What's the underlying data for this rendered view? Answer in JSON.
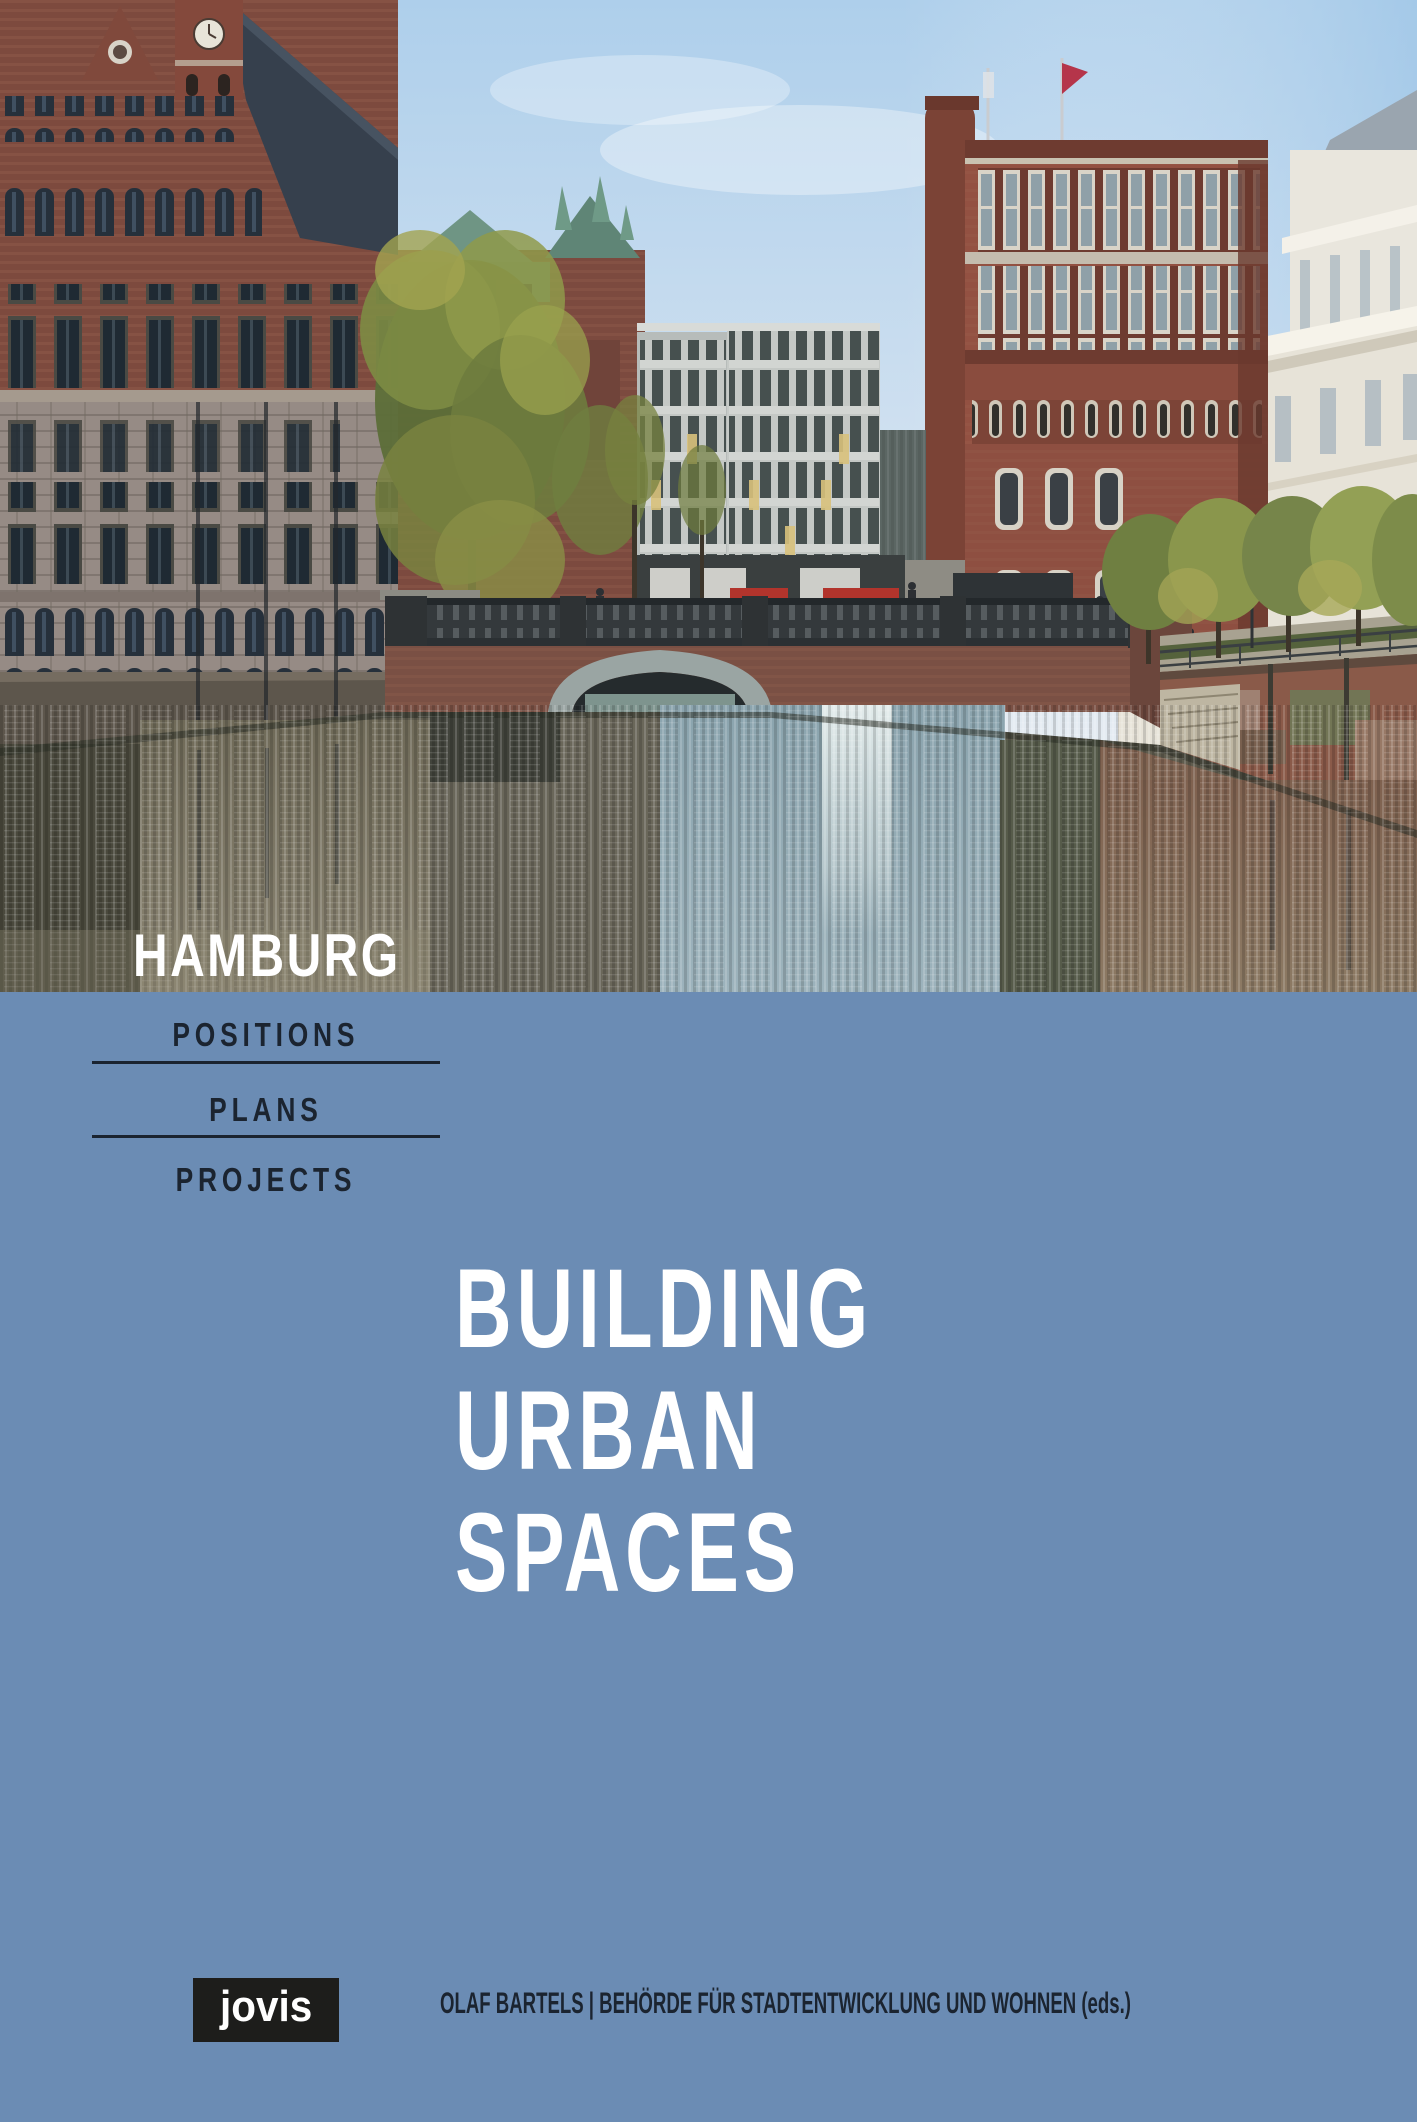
{
  "cover": {
    "location": "HAMBURG",
    "series": {
      "items": [
        {
          "label": "POSITIONS"
        },
        {
          "label": "PLANS"
        },
        {
          "label": "PROJECTS"
        }
      ]
    },
    "title": {
      "line1": "BUILDING",
      "line2": "URBAN",
      "line3": "SPACES"
    },
    "publisher_logo": "jovis",
    "editors": "OLAF BARTELS | BEHÖRDE FÜR STADTENTWICKLUNG UND WOHNEN (eds.)",
    "colors": {
      "panel": "#6b8cb4",
      "ink": "#1b2430",
      "paper": "#ffffff",
      "logo-bg": "#1d1d1b",
      "sky-top": "#aecfeb",
      "water-blue": "#8ba4ae",
      "brick": "#8a4f41"
    }
  }
}
